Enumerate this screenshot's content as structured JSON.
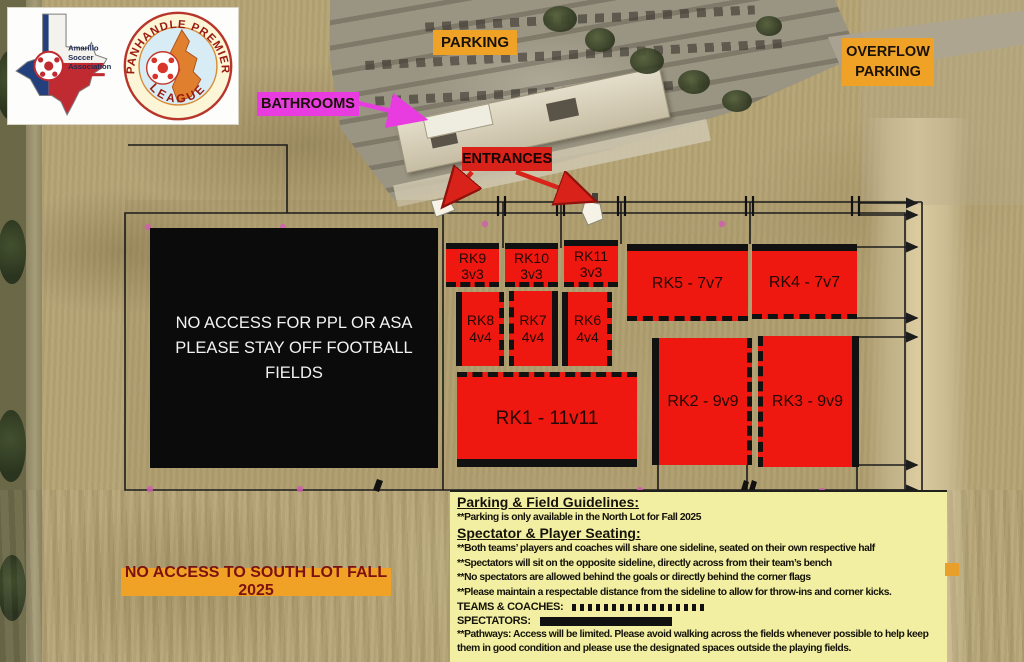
{
  "logos": {
    "asa": {
      "org_line1": "Amarillo",
      "org_line2": "Soccer",
      "org_line3": "Association"
    },
    "ppl": {
      "ring_top": "PANHANDLE PREMIER",
      "ring_bottom": "LEAGUE"
    }
  },
  "map_labels": {
    "parking": "PARKING",
    "overflow_line1": "OVERFLOW",
    "overflow_line2": "PARKING",
    "bathrooms": "BATHROOMS",
    "entrances": "ENTRANCES",
    "no_access_south": "NO ACCESS TO SOUTH LOT FALL 2025",
    "football_notice_line1": "NO ACCESS FOR PPL OR ASA",
    "football_notice_line2": "PLEASE STAY OFF FOOTBALL FIELDS"
  },
  "fields": {
    "rk9": {
      "name": "RK9",
      "size": "3v3"
    },
    "rk10": {
      "name": "RK10",
      "size": "3v3"
    },
    "rk11": {
      "name": "RK11",
      "size": "3v3"
    },
    "rk5": {
      "label": "RK5 - 7v7"
    },
    "rk4": {
      "label": "RK4 - 7v7"
    },
    "rk8": {
      "name": "RK8",
      "size": "4v4"
    },
    "rk7": {
      "name": "RK7",
      "size": "4v4"
    },
    "rk6": {
      "name": "RK6",
      "size": "4v4"
    },
    "rk1": {
      "label": "RK1 - 11v11"
    },
    "rk2": {
      "label": "RK2 - 9v9"
    },
    "rk3": {
      "label": "RK3 - 9v9"
    }
  },
  "guidelines": {
    "heading_parking": "Parking & Field Guidelines:",
    "parking_line": "**Parking is only available in the North Lot for Fall 2025",
    "heading_seating": "Spectator & Player Seating:",
    "seating_lines": [
      "**Both teams’ players and coaches will share one sideline, seated on their own respective half",
      "**Spectators will sit on the opposite sideline, directly across from their team’s bench",
      "**No spectators are allowed behind the goals or directly behind the corner flags",
      "**Please maintain a respectable distance from the sideline to allow for throw-ins and corner kicks."
    ],
    "legend_teams_label": "TEAMS & COACHES:",
    "legend_spectators_label": "SPECTATORS:",
    "pathways_note": "**Pathways: Access will be limited. Please avoid walking across the fields whenever possible to help keep them in good condition and please use the designated spaces outside the playing fields."
  },
  "colors": {
    "field_red": "#ee1810",
    "label_orange": "#f0a226",
    "bathrooms_magenta": "#e83ce0",
    "entrances_red": "#d8221a",
    "guidelines_yellow": "#f2efa2",
    "notice_black": "#0b0b0b"
  }
}
